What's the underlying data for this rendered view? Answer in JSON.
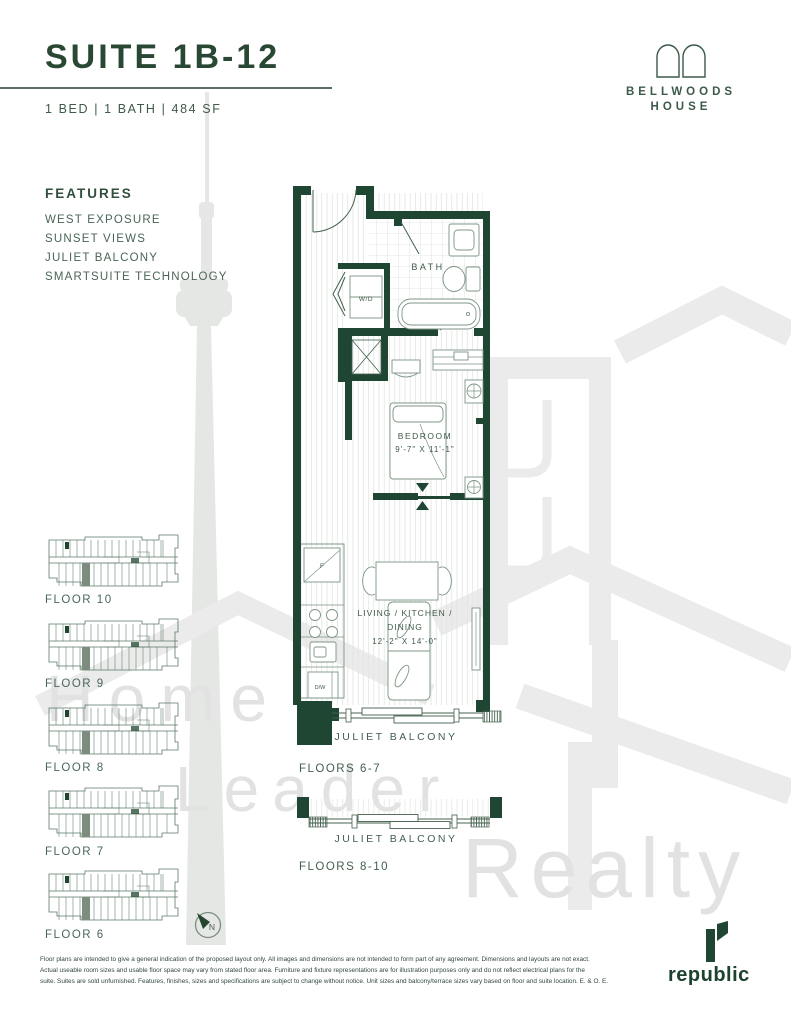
{
  "header": {
    "title": "SUITE 1B-12",
    "specs": "1 BED  |  1 BATH  |  484 SF"
  },
  "brand": {
    "line1": "BELLWOODS",
    "line2": "HOUSE"
  },
  "features": {
    "heading": "FEATURES",
    "items": [
      {
        "label": "WEST EXPOSURE"
      },
      {
        "label": "SUNSET VIEWS"
      },
      {
        "label": "JULIET BALCONY"
      },
      {
        "label": "SMARTSUITE TECHNOLOGY"
      }
    ]
  },
  "plan": {
    "bath": "BATH",
    "wd": "W/D",
    "fridge": "F",
    "dishwasher": "D/W",
    "bedroom": "BEDROOM",
    "bedroom_dims": "9'-7\" X 11'-1\"",
    "living_line1": "LIVING / KITCHEN /",
    "living_line2": "DINING",
    "living_dims": "12'-2\" X 14'-0\"",
    "balcony_1": "JULIET BALCONY",
    "floors_1": "FLOORS 6-7",
    "balcony_2": "JULIET BALCONY",
    "floors_2": "FLOORS 8-10"
  },
  "key_plans": [
    {
      "label": "FLOOR 10"
    },
    {
      "label": "FLOOR 9"
    },
    {
      "label": "FLOOR 8"
    },
    {
      "label": "FLOOR 7"
    },
    {
      "label": "FLOOR 6"
    }
  ],
  "compass": {
    "label": "N"
  },
  "watermark": {
    "word1": "Home",
    "word2": "Leader",
    "word3": "Realty"
  },
  "footer": {
    "disclaimer_line1": "Floor plans are intended to give a general indication of the proposed layout only. All images and dimensions are not intended to form part of any agreement. Dimensions and layouts are not exact.",
    "disclaimer_line2": "Actual useable room sizes and usable floor space may vary from stated floor area. Furniture and fixture representations are for illustration purposes only and do not reflect electrical plans for the",
    "disclaimer_line3": "suite. Suites are sold unfurnished. Features, finishes, sizes and specifications are subject to change without notice. Unit sizes and balcony/terrace sizes vary based on floor and suite location. E. & O. E.",
    "logo_text": "republic"
  },
  "colors": {
    "brand_green": "#1f4533",
    "label_green": "#44604f",
    "watermark_gray": "#e9e9e9"
  }
}
